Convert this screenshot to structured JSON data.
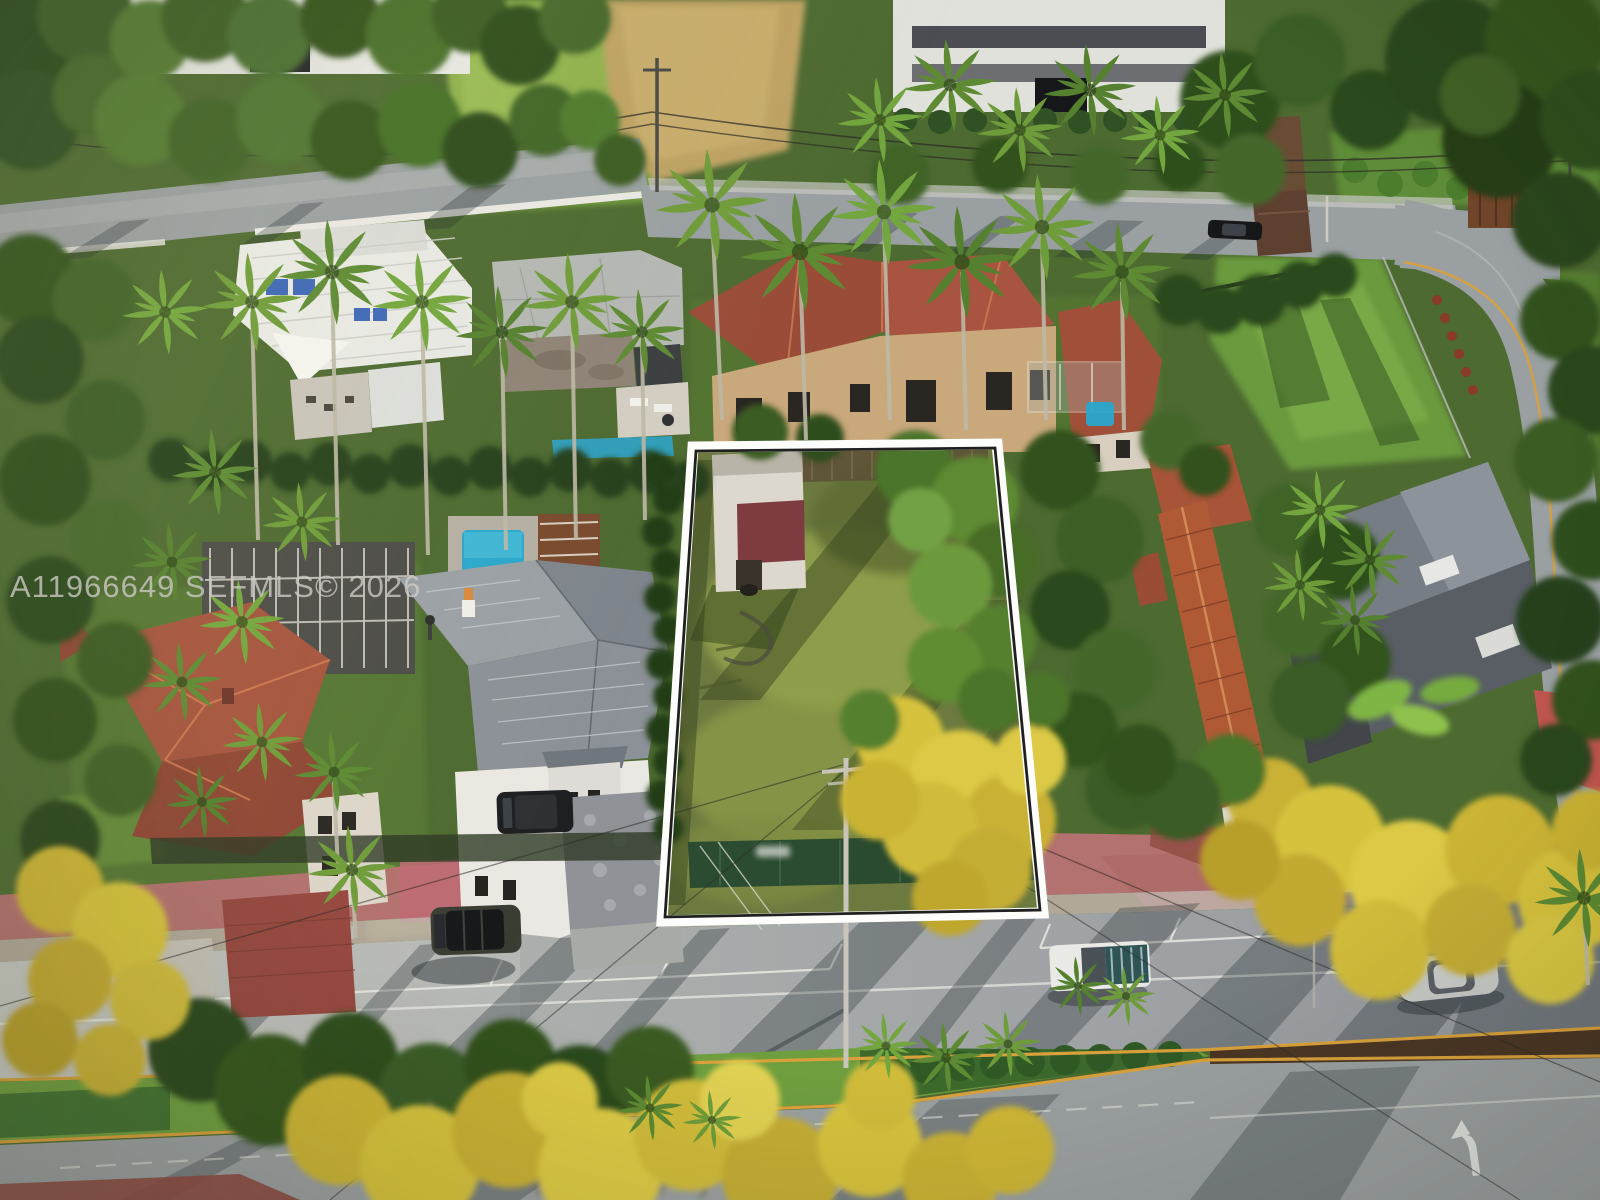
{
  "image": {
    "kind": "aerial-real-estate-photo",
    "description": "Aerial drone view of a tropical residential neighborhood; a vacant grassy lot in the center is outlined with a white property boundary overlay; streets, palm trees, tile-roof houses, a landscaped median and parked vehicles surround it.",
    "watermark": "A11966649 SEFMLS© 2026",
    "palette": {
      "boundary_white": "#fdfdfb",
      "boundary_black": "#0d0d0d",
      "watermark_gray": "#cecac7",
      "street_gray": "#a9adac",
      "sidewalk_pink": "#b3716f",
      "median_green": "#6f9e3f",
      "lane_yellow": "#d9a13b",
      "lot_grass_olive": "#6d7a3f",
      "canopy_dark_green": "#2c481c",
      "canopy_light_green": "#73a63e",
      "flowering_yellow": "#d6c23e",
      "roof_terracotta": "#a5543c",
      "roof_white": "#e8e9e5",
      "pool_blue": "#2aa7cc",
      "dirt_tan": "#bda263"
    }
  }
}
